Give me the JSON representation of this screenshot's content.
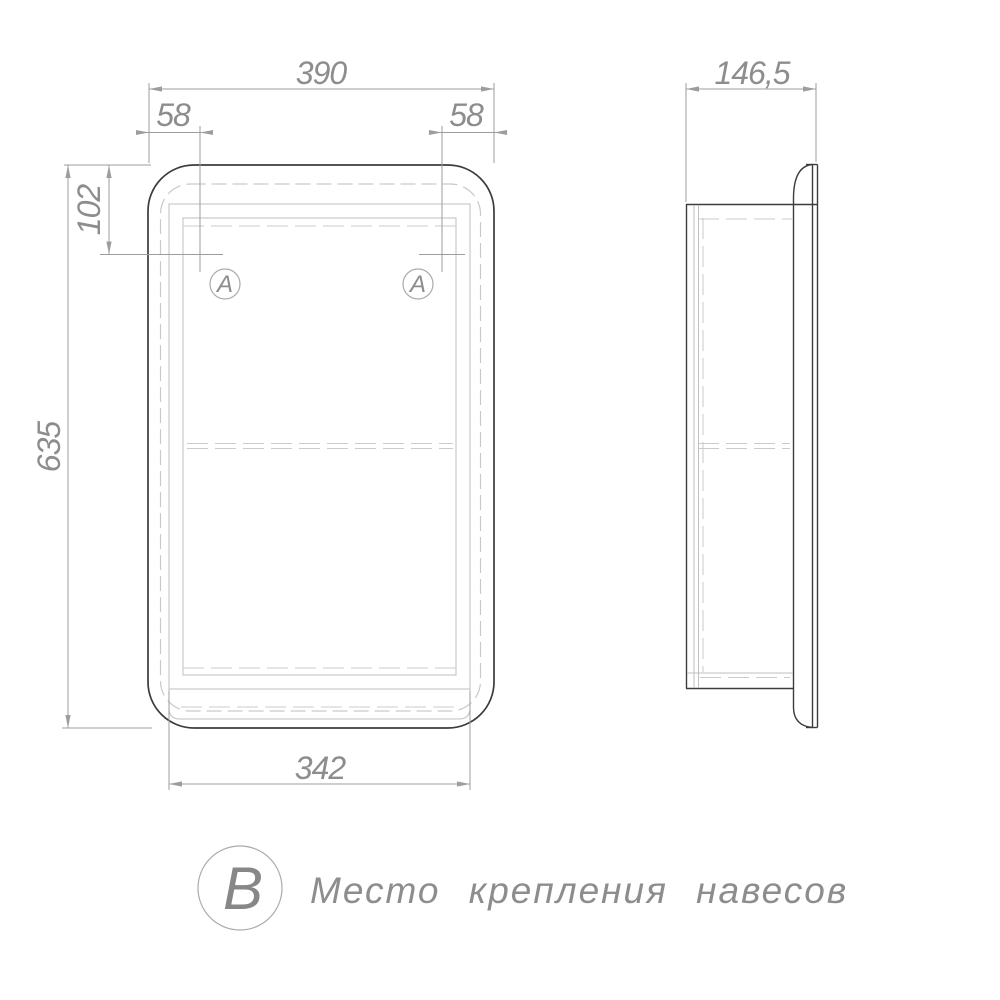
{
  "drawing_title": "Cabinet mirror dimensional drawing",
  "front_view": {
    "dim_width_top": "390",
    "dim_offset_left": "58",
    "dim_offset_right": "58",
    "dim_mount_drop": "102",
    "dim_height": "635",
    "dim_width_bottom": "342",
    "balloon_left": "A",
    "balloon_right": "A"
  },
  "side_view": {
    "dim_depth": "146,5"
  },
  "note": {
    "balloon": "B",
    "text": "Место крепления навесов"
  },
  "colors": {
    "background": "#ffffff",
    "outline": "#3c3c3c",
    "dimension_lines": "#9d9d9d",
    "hidden_lines": "#c9c9c9",
    "text": "#8d8d8d"
  }
}
